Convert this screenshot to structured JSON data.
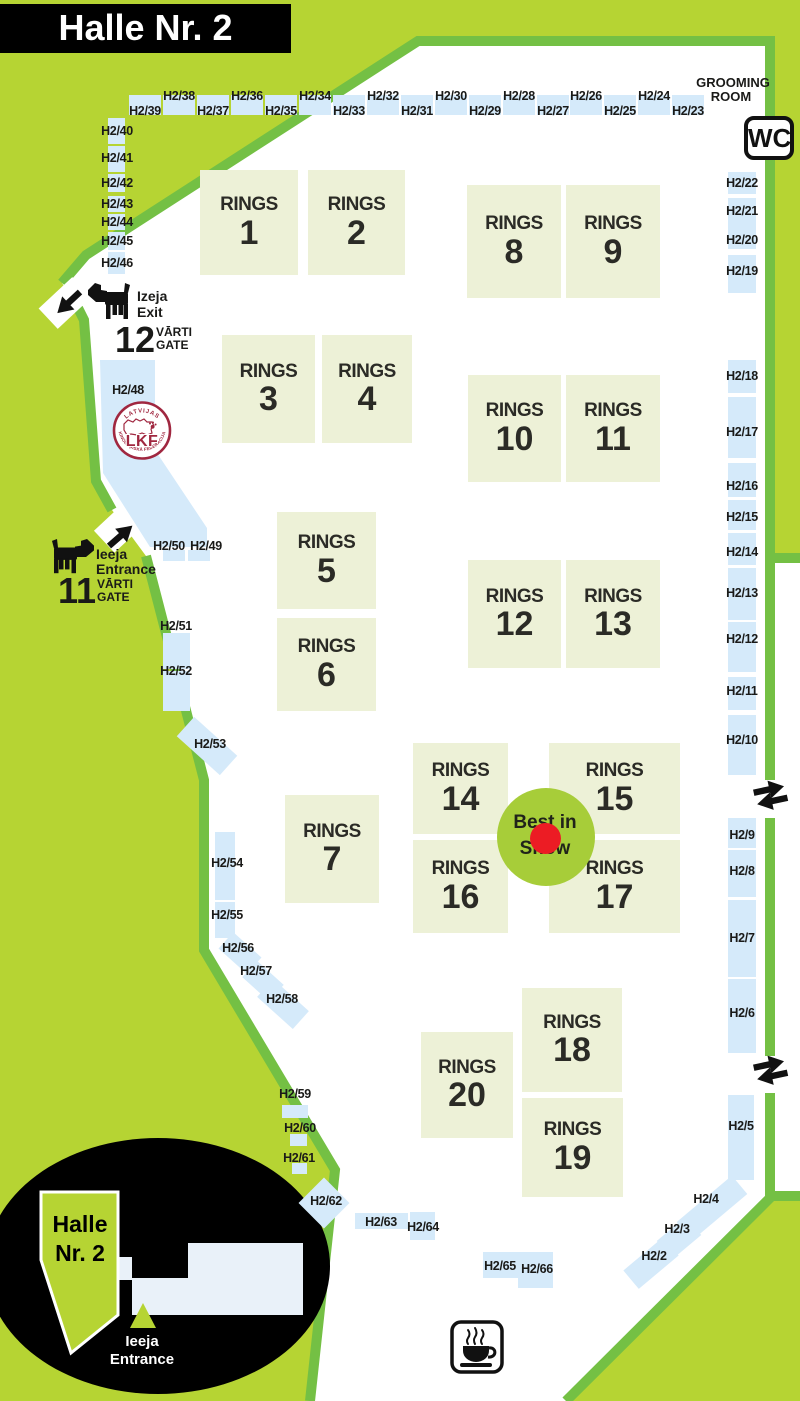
{
  "title": "Halle Nr. 2",
  "colors": {
    "background_lime": "#b6d433",
    "border_green": "#74c044",
    "ring_fill": "#edf1d7",
    "booth_blue": "#d5eafa",
    "lkf_maroon": "#a02740",
    "best_in_show_green": "#a7cd39",
    "best_in_show_red": "#ec1c24",
    "inset_pale": "#e9f1f9",
    "black": "#000000"
  },
  "grooming": {
    "line1": "GROOMING",
    "line2": "ROOM"
  },
  "wc": {
    "label": "WC"
  },
  "gates": {
    "exit": {
      "number": "12",
      "dir1": "Izeja",
      "dir2": "Exit",
      "gate1": "VĀRTI",
      "gate2": "GATE"
    },
    "entrance": {
      "number": "11",
      "dir1": "Ieeja",
      "dir2": "Entrance",
      "gate1": "VĀRTI",
      "gate2": "GATE"
    }
  },
  "lkf": {
    "top": "LATVIJAS",
    "bottom": "KINOLOĢISKĀ FEDERĀCIJA",
    "center": "LKF"
  },
  "best_in_show": {
    "line1": "Best in",
    "line2": "Show"
  },
  "inset": {
    "hall1": "Halle",
    "hall2": "Nr. 2",
    "ent1": "Ieeja",
    "ent2": "Entrance"
  },
  "rings_word": "RINGS",
  "rings": [
    {
      "n": "1",
      "x": 200,
      "y": 170,
      "w": 98,
      "h": 105
    },
    {
      "n": "2",
      "x": 308,
      "y": 170,
      "w": 97,
      "h": 105
    },
    {
      "n": "3",
      "x": 222,
      "y": 335,
      "w": 93,
      "h": 108
    },
    {
      "n": "4",
      "x": 322,
      "y": 335,
      "w": 90,
      "h": 108
    },
    {
      "n": "5",
      "x": 277,
      "y": 512,
      "w": 99,
      "h": 97
    },
    {
      "n": "6",
      "x": 277,
      "y": 618,
      "w": 99,
      "h": 93
    },
    {
      "n": "7",
      "x": 285,
      "y": 795,
      "w": 94,
      "h": 108
    },
    {
      "n": "8",
      "x": 467,
      "y": 185,
      "w": 94,
      "h": 113
    },
    {
      "n": "9",
      "x": 566,
      "y": 185,
      "w": 94,
      "h": 113
    },
    {
      "n": "10",
      "x": 468,
      "y": 375,
      "w": 93,
      "h": 107
    },
    {
      "n": "11",
      "x": 566,
      "y": 375,
      "w": 94,
      "h": 107
    },
    {
      "n": "12",
      "x": 468,
      "y": 560,
      "w": 93,
      "h": 108
    },
    {
      "n": "13",
      "x": 566,
      "y": 560,
      "w": 94,
      "h": 108
    },
    {
      "n": "14",
      "x": 413,
      "y": 743,
      "w": 95,
      "h": 91
    },
    {
      "n": "15",
      "x": 549,
      "y": 743,
      "w": 131,
      "h": 91
    },
    {
      "n": "16",
      "x": 413,
      "y": 840,
      "w": 95,
      "h": 93
    },
    {
      "n": "17",
      "x": 549,
      "y": 840,
      "w": 131,
      "h": 93
    },
    {
      "n": "18",
      "x": 522,
      "y": 988,
      "w": 100,
      "h": 104
    },
    {
      "n": "19",
      "x": 522,
      "y": 1098,
      "w": 101,
      "h": 99
    },
    {
      "n": "20",
      "x": 421,
      "y": 1032,
      "w": 92,
      "h": 106
    }
  ],
  "booths": [
    {
      "l": "H2/39",
      "x": 129,
      "y": 95,
      "w": 32,
      "h": 20,
      "lx": 145,
      "ly": 111
    },
    {
      "l": "H2/38",
      "x": 163,
      "y": 95,
      "w": 32,
      "h": 20,
      "lx": 179,
      "ly": 96
    },
    {
      "l": "H2/37",
      "x": 197,
      "y": 95,
      "w": 32,
      "h": 20,
      "lx": 213,
      "ly": 111
    },
    {
      "l": "H2/36",
      "x": 231,
      "y": 95,
      "w": 32,
      "h": 20,
      "lx": 247,
      "ly": 96
    },
    {
      "l": "H2/35",
      "x": 265,
      "y": 95,
      "w": 32,
      "h": 20,
      "lx": 281,
      "ly": 111
    },
    {
      "l": "H2/34",
      "x": 299,
      "y": 95,
      "w": 32,
      "h": 20,
      "lx": 315,
      "ly": 96
    },
    {
      "l": "H2/33",
      "x": 333,
      "y": 95,
      "w": 32,
      "h": 20,
      "lx": 349,
      "ly": 111
    },
    {
      "l": "H2/32",
      "x": 367,
      "y": 95,
      "w": 32,
      "h": 20,
      "lx": 383,
      "ly": 96
    },
    {
      "l": "H2/31",
      "x": 401,
      "y": 95,
      "w": 32,
      "h": 20,
      "lx": 417,
      "ly": 111
    },
    {
      "l": "H2/30",
      "x": 435,
      "y": 95,
      "w": 32,
      "h": 20,
      "lx": 451,
      "ly": 96
    },
    {
      "l": "H2/29",
      "x": 469,
      "y": 95,
      "w": 32,
      "h": 20,
      "lx": 485,
      "ly": 111
    },
    {
      "l": "H2/28",
      "x": 503,
      "y": 95,
      "w": 32,
      "h": 20,
      "lx": 519,
      "ly": 96
    },
    {
      "l": "H2/27",
      "x": 537,
      "y": 95,
      "w": 32,
      "h": 20,
      "lx": 553,
      "ly": 111
    },
    {
      "l": "H2/26",
      "x": 570,
      "y": 95,
      "w": 32,
      "h": 20,
      "lx": 586,
      "ly": 96
    },
    {
      "l": "H2/25",
      "x": 604,
      "y": 95,
      "w": 32,
      "h": 20,
      "lx": 620,
      "ly": 111
    },
    {
      "l": "H2/24",
      "x": 638,
      "y": 95,
      "w": 32,
      "h": 20,
      "lx": 654,
      "ly": 96
    },
    {
      "l": "H2/23",
      "x": 672,
      "y": 95,
      "w": 32,
      "h": 20,
      "lx": 688,
      "ly": 111
    },
    {
      "l": "H2/40",
      "x": 108,
      "y": 118,
      "w": 17,
      "h": 26,
      "lx": 117,
      "ly": 131
    },
    {
      "l": "H2/41",
      "x": 108,
      "y": 146,
      "w": 17,
      "h": 26,
      "lx": 117,
      "ly": 158
    },
    {
      "l": "H2/42",
      "x": 108,
      "y": 174,
      "w": 17,
      "h": 18,
      "lx": 117,
      "ly": 183
    },
    {
      "l": "H2/43",
      "x": 108,
      "y": 196,
      "w": 17,
      "h": 16,
      "lx": 117,
      "ly": 204
    },
    {
      "l": "H2/44",
      "x": 108,
      "y": 214,
      "w": 17,
      "h": 16,
      "lx": 117,
      "ly": 222
    },
    {
      "l": "H2/45",
      "x": 108,
      "y": 232,
      "w": 17,
      "h": 18,
      "lx": 117,
      "ly": 241
    },
    {
      "l": "H2/46",
      "x": 108,
      "y": 252,
      "w": 17,
      "h": 22,
      "lx": 117,
      "ly": 263
    },
    {
      "l": "H2/48",
      "x": 0,
      "y": 0,
      "w": 0,
      "h": 0,
      "lx": 128,
      "ly": 390
    },
    {
      "l": "H2/50",
      "x": 163,
      "y": 550,
      "w": 22,
      "h": 11,
      "lx": 169,
      "ly": 546
    },
    {
      "l": "H2/49",
      "x": 188,
      "y": 550,
      "w": 22,
      "h": 11,
      "lx": 206,
      "ly": 546
    },
    {
      "l": "H2/51",
      "x": 163,
      "y": 633,
      "w": 27,
      "h": 36,
      "lx": 176,
      "ly": 626
    },
    {
      "l": "H2/52",
      "x": 163,
      "y": 671,
      "w": 27,
      "h": 40,
      "lx": 176,
      "ly": 671
    },
    {
      "l": "H2/53",
      "x": 178,
      "y": 733,
      "w": 58,
      "h": 26,
      "r": 42,
      "lx": 210,
      "ly": 744
    },
    {
      "l": "H2/54",
      "x": 215,
      "y": 832,
      "w": 20,
      "h": 68,
      "lx": 227,
      "ly": 863
    },
    {
      "l": "H2/55",
      "x": 215,
      "y": 902,
      "w": 20,
      "h": 36,
      "lx": 227,
      "ly": 915
    },
    {
      "l": "H2/56",
      "x": 221,
      "y": 942,
      "w": 38,
      "h": 22,
      "r": 42,
      "lx": 238,
      "ly": 948
    },
    {
      "l": "H2/57",
      "x": 245,
      "y": 970,
      "w": 36,
      "h": 22,
      "r": 42,
      "lx": 256,
      "ly": 971
    },
    {
      "l": "H2/58",
      "x": 259,
      "y": 992,
      "w": 48,
      "h": 24,
      "r": 42,
      "lx": 282,
      "ly": 999
    },
    {
      "l": "H2/22",
      "x": 728,
      "y": 172,
      "w": 28,
      "h": 22,
      "lx": 742,
      "ly": 183
    },
    {
      "l": "H2/21",
      "x": 728,
      "y": 198,
      "w": 28,
      "h": 34,
      "lx": 742,
      "ly": 211
    },
    {
      "l": "H2/20",
      "x": 728,
      "y": 227,
      "w": 28,
      "h": 22,
      "lx": 742,
      "ly": 240
    },
    {
      "l": "H2/19",
      "x": 728,
      "y": 255,
      "w": 28,
      "h": 38,
      "lx": 742,
      "ly": 271
    },
    {
      "l": "H2/18",
      "x": 728,
      "y": 360,
      "w": 28,
      "h": 33,
      "lx": 742,
      "ly": 376
    },
    {
      "l": "H2/17",
      "x": 728,
      "y": 397,
      "w": 28,
      "h": 61,
      "lx": 742,
      "ly": 432
    },
    {
      "l": "H2/16",
      "x": 728,
      "y": 463,
      "w": 28,
      "h": 34,
      "lx": 742,
      "ly": 486
    },
    {
      "l": "H2/15",
      "x": 728,
      "y": 500,
      "w": 28,
      "h": 30,
      "lx": 742,
      "ly": 517
    },
    {
      "l": "H2/14",
      "x": 728,
      "y": 533,
      "w": 28,
      "h": 32,
      "lx": 742,
      "ly": 552
    },
    {
      "l": "H2/13",
      "x": 728,
      "y": 568,
      "w": 28,
      "h": 52,
      "lx": 742,
      "ly": 593
    },
    {
      "l": "H2/12",
      "x": 728,
      "y": 622,
      "w": 28,
      "h": 50,
      "lx": 742,
      "ly": 639
    },
    {
      "l": "H2/11",
      "x": 728,
      "y": 677,
      "w": 28,
      "h": 33,
      "lx": 742,
      "ly": 691
    },
    {
      "l": "H2/10",
      "x": 728,
      "y": 715,
      "w": 28,
      "h": 60,
      "lx": 742,
      "ly": 740
    },
    {
      "l": "H2/9",
      "x": 728,
      "y": 818,
      "w": 28,
      "h": 30,
      "lx": 742,
      "ly": 835
    },
    {
      "l": "H2/8",
      "x": 728,
      "y": 850,
      "w": 28,
      "h": 47,
      "lx": 742,
      "ly": 871
    },
    {
      "l": "H2/7",
      "x": 728,
      "y": 900,
      "w": 28,
      "h": 77,
      "lx": 742,
      "ly": 938
    },
    {
      "l": "H2/6",
      "x": 728,
      "y": 979,
      "w": 28,
      "h": 74,
      "lx": 742,
      "ly": 1013
    },
    {
      "l": "H2/5",
      "x": 728,
      "y": 1095,
      "w": 26,
      "h": 85,
      "lx": 741,
      "ly": 1126
    },
    {
      "l": "H2/4",
      "x": 676,
      "y": 1196,
      "w": 72,
      "h": 24,
      "r": -40,
      "lx": 706,
      "ly": 1199
    },
    {
      "l": "H2/3",
      "x": 660,
      "y": 1226,
      "w": 38,
      "h": 24,
      "r": -40,
      "lx": 677,
      "ly": 1229
    },
    {
      "l": "H2/2",
      "x": 625,
      "y": 1251,
      "w": 52,
      "h": 24,
      "r": -40,
      "lx": 654,
      "ly": 1256
    },
    {
      "l": "H2/59",
      "x": 282,
      "y": 1105,
      "w": 26,
      "h": 13,
      "lx": 295,
      "ly": 1094
    },
    {
      "l": "H2/60",
      "x": 290,
      "y": 1134,
      "w": 17,
      "h": 12,
      "lx": 300,
      "ly": 1128
    },
    {
      "l": "H2/61",
      "x": 292,
      "y": 1163,
      "w": 15,
      "h": 11,
      "lx": 299,
      "ly": 1158
    },
    {
      "l": "H2/62",
      "x": 306,
      "y": 1185,
      "w": 36,
      "h": 36,
      "r": 45,
      "lx": 326,
      "ly": 1201
    },
    {
      "l": "H2/63",
      "x": 355,
      "y": 1213,
      "w": 53,
      "h": 16,
      "lx": 381,
      "ly": 1222
    },
    {
      "l": "H2/64",
      "x": 410,
      "y": 1212,
      "w": 25,
      "h": 28,
      "lx": 423,
      "ly": 1227
    },
    {
      "l": "H2/65",
      "x": 483,
      "y": 1252,
      "w": 35,
      "h": 26,
      "lx": 500,
      "ly": 1266
    },
    {
      "l": "H2/66",
      "x": 518,
      "y": 1252,
      "w": 35,
      "h": 36,
      "lx": 537,
      "ly": 1269
    }
  ]
}
